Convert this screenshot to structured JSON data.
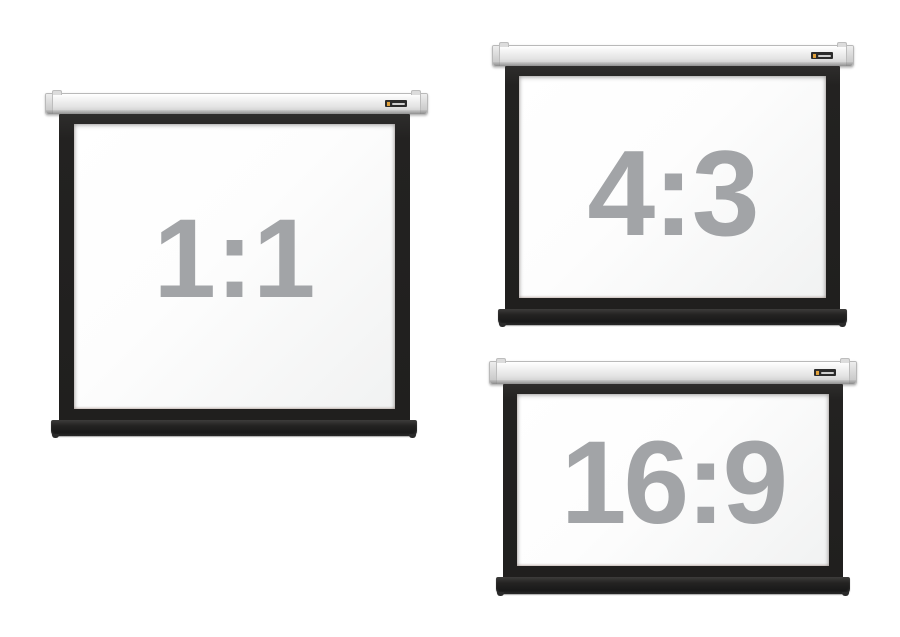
{
  "image": {
    "kind": "product-photo-collage",
    "subject": "Three wall-mounted roll-down projection screens shown in different aspect ratios"
  },
  "screens": [
    {
      "id": "screen-1-1",
      "aspect_ratio_label": "1:1"
    },
    {
      "id": "screen-4-3",
      "aspect_ratio_label": "4:3"
    },
    {
      "id": "screen-16-9",
      "aspect_ratio_label": "16:9"
    }
  ],
  "brand_logo": {
    "icon": "elite-screens-logo",
    "body_color": "#2b2b2b",
    "accent_color": "#e2a23b"
  },
  "colors": {
    "background": "#ffffff",
    "label_gray": "#a2a4a7",
    "casing_light": "#f7f7f7",
    "casing_mid": "#e4e4e4",
    "casing_dark": "#c7c7c7",
    "frame_black": "#232221",
    "bar_black": "#1a1a1a",
    "surface_white": "#fdfdfd"
  }
}
